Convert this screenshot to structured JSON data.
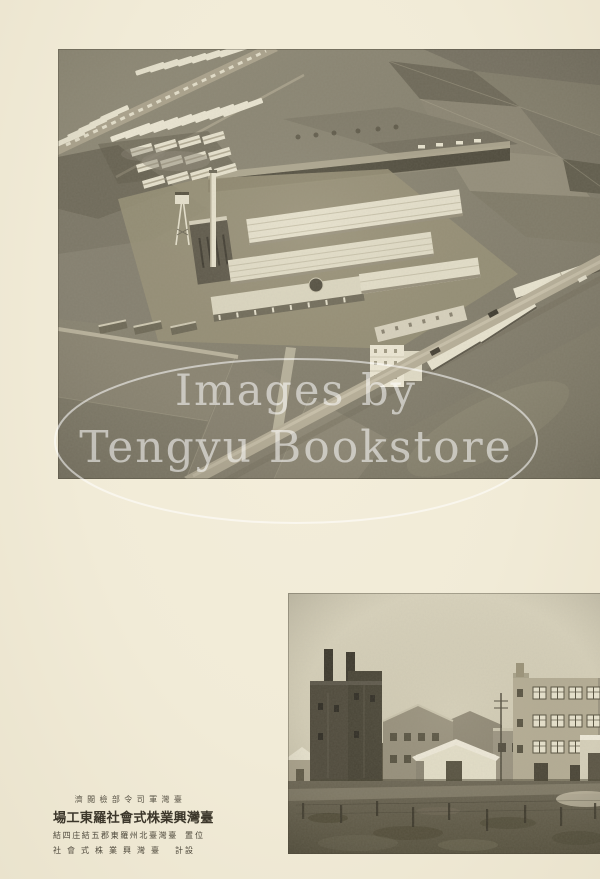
{
  "watermark": {
    "line1": "Images by",
    "line2": "Tengyu Bookstore"
  },
  "caption": {
    "censor_stamp": "臺灣軍司令部檢閲濟",
    "title": "臺灣興業株式會社羅東工場",
    "location_label": "位置",
    "location_value": "臺灣臺北州羅東郡五結庄四結",
    "designer_label": "設計",
    "designer_value": "臺灣興業株式會社"
  },
  "colors": {
    "paper": "#f1ebd7",
    "ink": "#3c372b",
    "photo_light": "#e8e3cf",
    "photo_mid": "#8a8472",
    "photo_dark": "#55503f",
    "watermark": "#ffffff"
  }
}
